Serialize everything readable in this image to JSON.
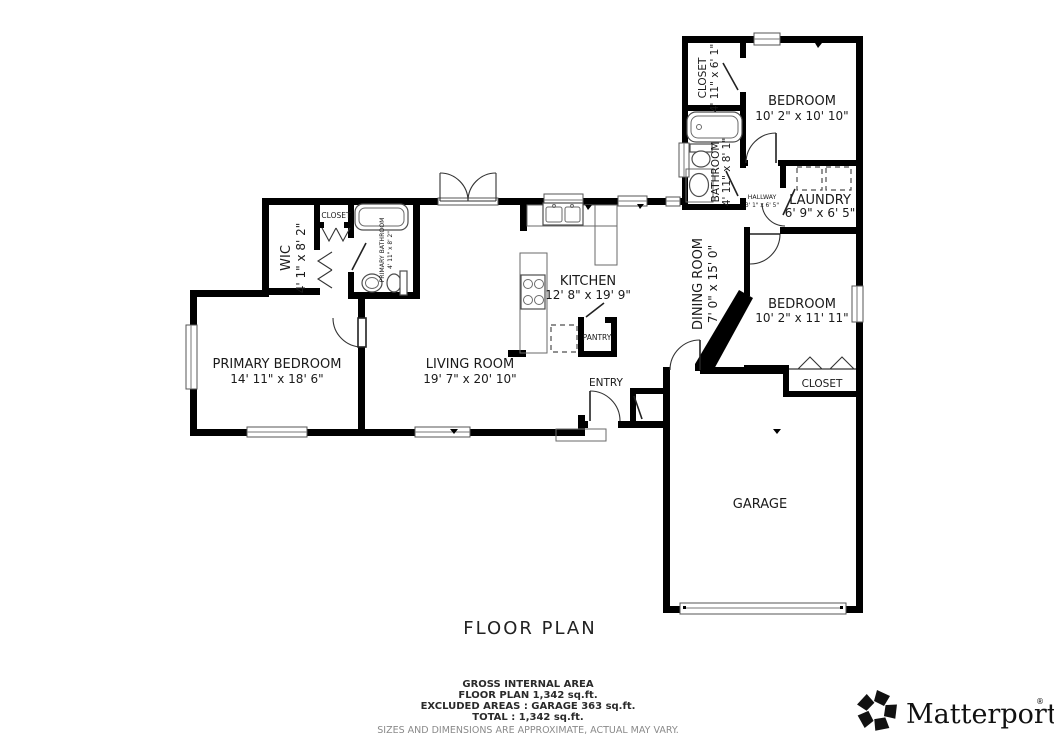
{
  "floorplan": {
    "rooms": {
      "closet_top_right": {
        "name": "CLOSET",
        "dims": "4' 11\" x 6' 1\""
      },
      "bedroom_top": {
        "name": "BEDROOM",
        "dims": "10' 2\" x 10' 10\""
      },
      "bathroom": {
        "name": "BATHROOM",
        "dims": "4' 11\" x 8' 1\""
      },
      "hallway": {
        "name": "HALLWAY",
        "dims": "3' 1\" x 6' 5\""
      },
      "laundry": {
        "name": "LAUNDRY",
        "dims": "6' 9\" x 6' 5\""
      },
      "bedroom_right": {
        "name": "BEDROOM",
        "dims": "10' 2\" x 11' 11\""
      },
      "closet_bedroom_right": {
        "name": "CLOSET"
      },
      "garage": {
        "name": "GARAGE"
      },
      "dining_room": {
        "name": "DINING ROOM",
        "dims": "7' 0\" x 15' 0\""
      },
      "kitchen": {
        "name": "KITCHEN",
        "dims": "12' 8\" x 19' 9\""
      },
      "pantry": {
        "name": "PANTRY"
      },
      "entry": {
        "name": "ENTRY"
      },
      "living_room": {
        "name": "LIVING ROOM",
        "dims": "19' 7\" x 20' 10\""
      },
      "primary_bedroom": {
        "name": "PRIMARY BEDROOM",
        "dims": "14' 11\" x 18' 6\""
      },
      "wic": {
        "name": "WIC",
        "dims": "4' 1\" x 8' 2\""
      },
      "closet_hall": {
        "name": "CLOSET"
      },
      "primary_bathroom": {
        "name": "PRIMARY BATHROOM",
        "dims": "4' 11\" x 8' 2\""
      }
    },
    "footer": {
      "title": "FLOOR PLAN",
      "area_lines": [
        "GROSS INTERNAL AREA",
        "FLOOR PLAN 1,342 sq.ft.",
        "EXCLUDED AREAS :  GARAGE 363 sq.ft.",
        "TOTAL :  1,342 sq.ft."
      ],
      "disclaimer": "SIZES AND DIMENSIONS ARE APPROXIMATE, ACTUAL MAY VARY."
    },
    "brand": {
      "name": "Matterport",
      "registered_mark": "®",
      "logo_icon": "matterport-pinwheel-icon"
    },
    "colors": {
      "wall": "#000000",
      "label": "#1a1a1a",
      "fixture_stroke": "#4d4d4d",
      "disclaimer": "#8a8a8a"
    }
  }
}
